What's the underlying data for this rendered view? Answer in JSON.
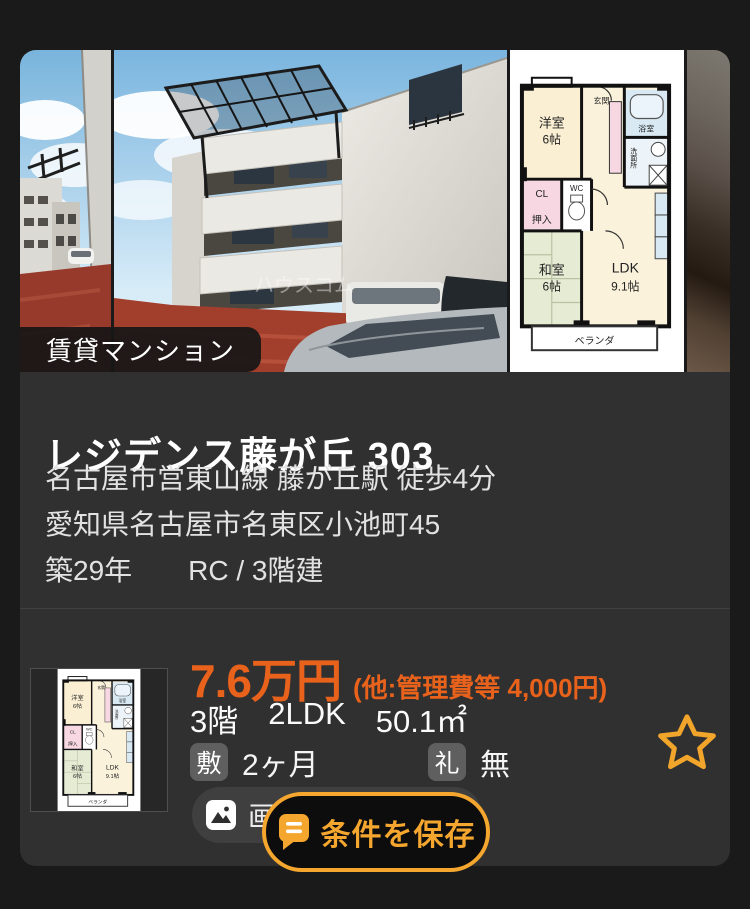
{
  "badge": {
    "label": "賃貸マンション"
  },
  "listing": {
    "title": "レジデンス藤が丘 303",
    "access": "名古屋市営東山線 藤が丘駅 徒歩4分",
    "address": "愛知県名古屋市名東区小池町45",
    "age": "築29年",
    "structure": "RC / 3階建"
  },
  "price": {
    "rent": "7.6万円",
    "extra_fees": "(他:管理費等 4,000円)"
  },
  "specs": {
    "floor": "3階",
    "layout": "2LDK",
    "area": "50.1㎡"
  },
  "fees": {
    "deposit_badge": "敷",
    "deposit_value": "2ヶ月",
    "key_money_badge": "礼",
    "key_money_value": "無"
  },
  "actions": {
    "images_label": "画像",
    "save_label": "条件を保存"
  },
  "photo": {
    "watermark": "ハウスコム"
  },
  "floor_plan": {
    "western_room": "洋室",
    "western_room_size": "6帖",
    "entrance": "玄関",
    "bath": "浴室",
    "washroom": "洗面所",
    "closet": "CL",
    "wc": "WC",
    "storage": "押入",
    "japanese_room": "和室",
    "japanese_room_size": "6帖",
    "ldk": "LDK",
    "ldk_size": "9.1帖",
    "veranda": "ベランダ"
  },
  "colors": {
    "accent_orange": "#E9621C",
    "accent_amber": "#F4A62E"
  }
}
